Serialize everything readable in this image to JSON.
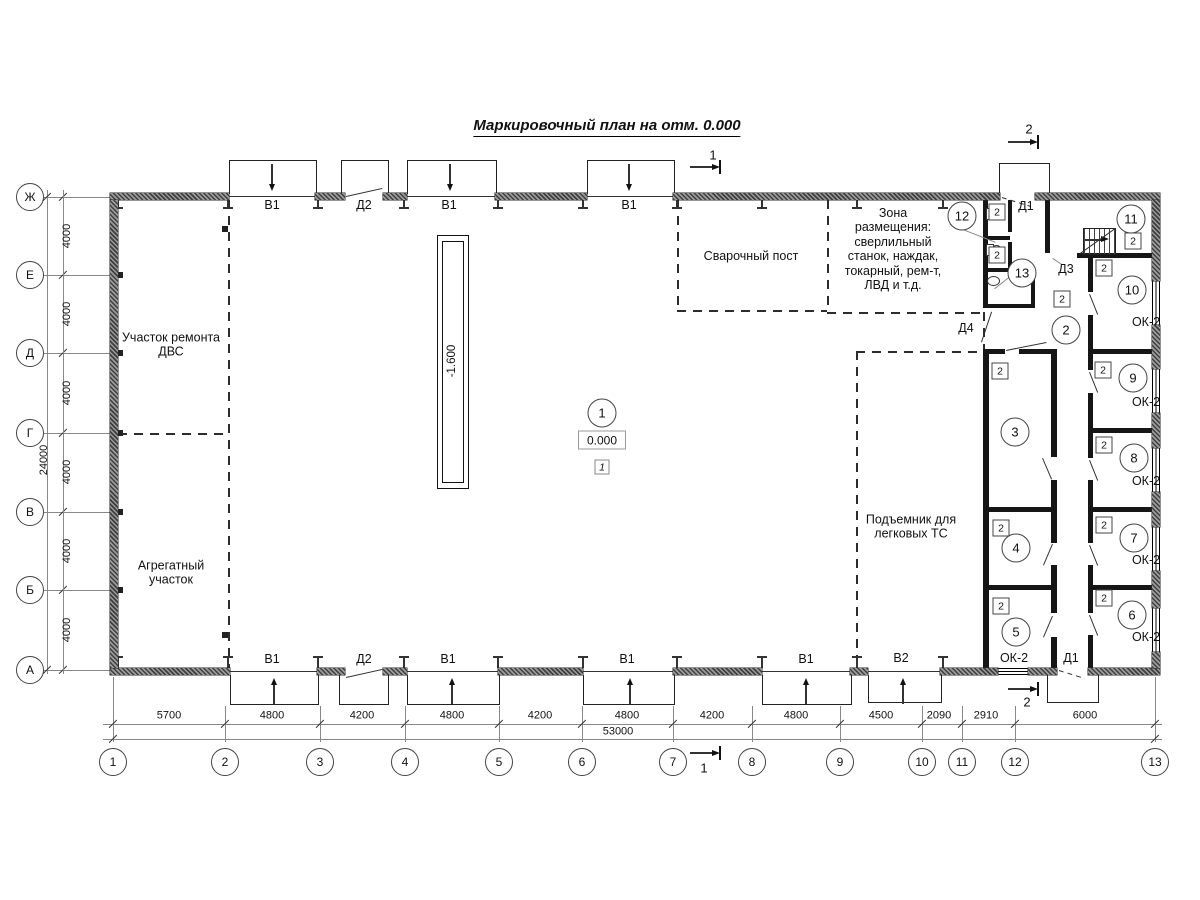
{
  "title": "Маркировочный план на отм. 0.000",
  "plan": {
    "row_axes": [
      {
        "label": "Ж",
        "y": 197
      },
      {
        "label": "Е",
        "y": 275
      },
      {
        "label": "Д",
        "y": 353
      },
      {
        "label": "Г",
        "y": 433
      },
      {
        "label": "В",
        "y": 512
      },
      {
        "label": "Б",
        "y": 590
      },
      {
        "label": "А",
        "y": 670
      }
    ],
    "row_dims": [
      {
        "text": "4000",
        "y": 236
      },
      {
        "text": "4000",
        "y": 314
      },
      {
        "text": "4000",
        "y": 393
      },
      {
        "text": "4000",
        "y": 472
      },
      {
        "text": "4000",
        "y": 551
      },
      {
        "text": "4000",
        "y": 630
      }
    ],
    "row_total": {
      "text": "24000",
      "y": 460
    },
    "col_axes": [
      {
        "label": "1",
        "x": 113
      },
      {
        "label": "2",
        "x": 225
      },
      {
        "label": "3",
        "x": 320
      },
      {
        "label": "4",
        "x": 405
      },
      {
        "label": "5",
        "x": 499
      },
      {
        "label": "6",
        "x": 582
      },
      {
        "label": "7",
        "x": 673
      },
      {
        "label": "8",
        "x": 752
      },
      {
        "label": "9",
        "x": 840
      },
      {
        "label": "10",
        "x": 922
      },
      {
        "label": "11",
        "x": 962
      },
      {
        "label": "12",
        "x": 1015
      },
      {
        "label": "13",
        "x": 1155
      }
    ],
    "col_dims": [
      {
        "text": "5700",
        "x": 169
      },
      {
        "text": "4800",
        "x": 272
      },
      {
        "text": "4200",
        "x": 362
      },
      {
        "text": "4800",
        "x": 452
      },
      {
        "text": "4200",
        "x": 540
      },
      {
        "text": "4800",
        "x": 627
      },
      {
        "text": "4200",
        "x": 712
      },
      {
        "text": "4800",
        "x": 796
      },
      {
        "text": "4500",
        "x": 881
      },
      {
        "text": "2090",
        "x": 939
      },
      {
        "text": "2910",
        "x": 986
      },
      {
        "text": "6000",
        "x": 1085
      }
    ],
    "col_total": {
      "text": "53000",
      "x": 618,
      "y": 732
    },
    "opening_labels": [
      {
        "text": "В1",
        "x": 272,
        "y": 205
      },
      {
        "text": "Д2",
        "x": 364,
        "y": 205
      },
      {
        "text": "В1",
        "x": 449,
        "y": 205
      },
      {
        "text": "В1",
        "x": 629,
        "y": 205
      },
      {
        "text": "Д1",
        "x": 1026,
        "y": 206
      },
      {
        "text": "Д3",
        "x": 1066,
        "y": 269
      },
      {
        "text": "Д4",
        "x": 966,
        "y": 328
      },
      {
        "text": "В1",
        "x": 272,
        "y": 659
      },
      {
        "text": "Д2",
        "x": 364,
        "y": 659
      },
      {
        "text": "В1",
        "x": 448,
        "y": 659
      },
      {
        "text": "В1",
        "x": 627,
        "y": 659
      },
      {
        "text": "В1",
        "x": 806,
        "y": 659
      },
      {
        "text": "В2",
        "x": 901,
        "y": 658
      },
      {
        "text": "ОК-2",
        "x": 1014,
        "y": 658
      },
      {
        "text": "Д1",
        "x": 1071,
        "y": 658
      },
      {
        "text": "ОК-2",
        "x": 1146,
        "y": 322
      },
      {
        "text": "ОК-2",
        "x": 1146,
        "y": 402
      },
      {
        "text": "ОК-2",
        "x": 1146,
        "y": 481
      },
      {
        "text": "ОК-2",
        "x": 1146,
        "y": 560
      },
      {
        "text": "ОК-2",
        "x": 1146,
        "y": 637
      }
    ],
    "zone_texts": [
      {
        "lines": [
          "Участок ремонта",
          "ДВС"
        ],
        "x": 171,
        "y": 345
      },
      {
        "lines": [
          "Агрегатный",
          "участок"
        ],
        "x": 171,
        "y": 573
      },
      {
        "lines": [
          "Сварочный пост"
        ],
        "x": 751,
        "y": 256
      },
      {
        "lines": [
          "Зона",
          "размещения:",
          "сверлильный",
          "станок, наждак,",
          "токарный, рем-т,",
          "ЛВД и т.д."
        ],
        "x": 893,
        "y": 249
      },
      {
        "lines": [
          "Подъемник для",
          "легковых ТС"
        ],
        "x": 911,
        "y": 527
      }
    ],
    "rooms": [
      {
        "num": "1",
        "x": 602,
        "y": 413
      },
      {
        "num": "2",
        "x": 1066,
        "y": 330
      },
      {
        "num": "3",
        "x": 1015,
        "y": 432
      },
      {
        "num": "4",
        "x": 1016,
        "y": 548
      },
      {
        "num": "5",
        "x": 1016,
        "y": 632
      },
      {
        "num": "6",
        "x": 1132,
        "y": 615
      },
      {
        "num": "7",
        "x": 1134,
        "y": 538
      },
      {
        "num": "8",
        "x": 1134,
        "y": 458
      },
      {
        "num": "9",
        "x": 1133,
        "y": 378
      },
      {
        "num": "10",
        "x": 1132,
        "y": 290
      },
      {
        "num": "11",
        "x": 1131,
        "y": 219
      },
      {
        "num": "12",
        "x": 962,
        "y": 216
      },
      {
        "num": "13",
        "x": 1022,
        "y": 273
      }
    ],
    "tag_value": "2",
    "tags": [
      {
        "x": 997,
        "y": 212
      },
      {
        "x": 997,
        "y": 255
      },
      {
        "x": 1062,
        "y": 299
      },
      {
        "x": 1133,
        "y": 241
      },
      {
        "x": 1104,
        "y": 268
      },
      {
        "x": 1000,
        "y": 371
      },
      {
        "x": 1103,
        "y": 370
      },
      {
        "x": 1104,
        "y": 445
      },
      {
        "x": 1104,
        "y": 525
      },
      {
        "x": 1104,
        "y": 598
      },
      {
        "x": 1001,
        "y": 528
      },
      {
        "x": 1001,
        "y": 606
      }
    ],
    "elevations": {
      "pit": {
        "text": "-1.600",
        "x": 452,
        "y": 361
      },
      "floor": {
        "text": "0.000",
        "x": 602,
        "y": 440
      },
      "floor_tag": {
        "text": "1",
        "x": 602,
        "y": 467
      }
    },
    "sections": [
      {
        "num": "1",
        "x": 713,
        "y": 156,
        "ax": 690,
        "ay": 167
      },
      {
        "num": "1",
        "x": 704,
        "y": 769,
        "ax": 690,
        "ay": 753
      },
      {
        "num": "2",
        "x": 1029,
        "y": 130,
        "ax": 1008,
        "ay": 142
      },
      {
        "num": "2",
        "x": 1027,
        "y": 703,
        "ax": 1008,
        "ay": 689
      }
    ]
  }
}
